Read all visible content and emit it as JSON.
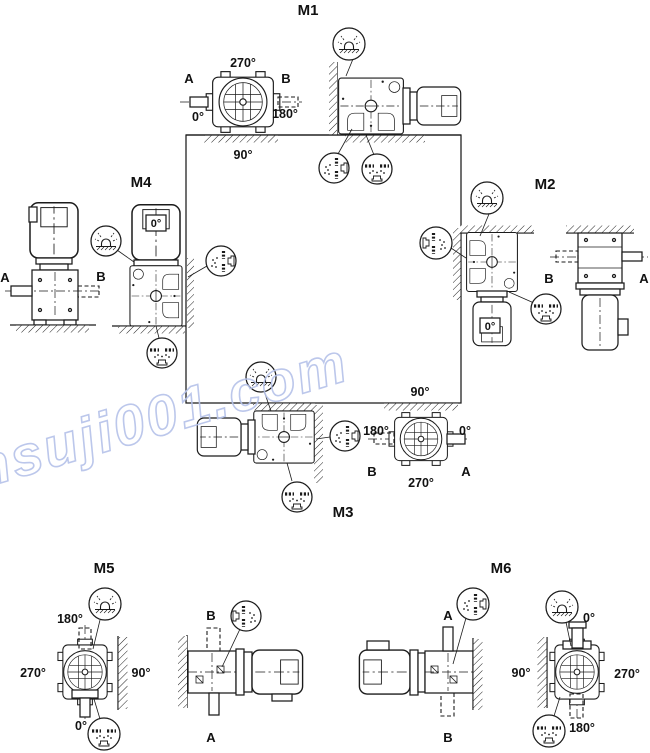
{
  "diagram": {
    "watermark": "www.jiansuji001.com",
    "colors": {
      "ink": "#1b1b1b",
      "watermark": "#b5c2e9"
    },
    "symbols": {
      "breather": "breather-valve-icon",
      "oil_level": "oil-level-plug-icon",
      "oil_drain": "oil-drain-plug-icon"
    },
    "m1": {
      "title": "M1",
      "deg_top": "270°",
      "deg_left": "0°",
      "deg_right": "180°",
      "deg_bottom": "90°",
      "label_a": "A",
      "label_b": "B"
    },
    "m2": {
      "title": "M2",
      "motor_deg": "0°",
      "label_b": "B",
      "label_a": "A"
    },
    "m3": {
      "title": "M3",
      "deg_top": "90°",
      "deg_left": "180°",
      "deg_right": "0°",
      "deg_bottom": "270°",
      "label_b": "B",
      "label_a": "A"
    },
    "m4": {
      "title": "M4",
      "motor_deg": "0°",
      "label_a": "A",
      "label_b": "B"
    },
    "m5": {
      "title": "M5",
      "deg_top": "180°",
      "deg_left": "270°",
      "deg_right": "90°",
      "deg_bottom": "0°",
      "label_b": "B",
      "label_a": "A"
    },
    "m6": {
      "title": "M6",
      "deg_top": "0°",
      "deg_left": "90°",
      "deg_right": "270°",
      "deg_bottom": "180°",
      "label_a": "A",
      "label_b": "B"
    }
  }
}
